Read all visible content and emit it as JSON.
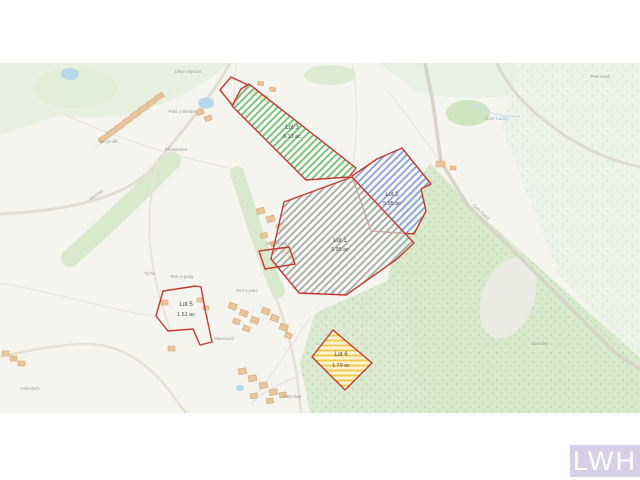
{
  "page": {
    "background": "#ffffff"
  },
  "logo": {
    "text": "LWH",
    "background": "#d6cfe7",
    "text_color": "#ffffff"
  },
  "lots": [
    {
      "name": "Lot 1",
      "area": "9.95 ac",
      "fill_style": "grey-hatch",
      "outline": "#c23b33"
    },
    {
      "name": "Lot 2",
      "area": "5.95 ac",
      "fill_style": "blue-hatch",
      "outline": "#c23b33"
    },
    {
      "name": "Lot 3",
      "area": "6.13 ac",
      "fill_style": "green-hatch",
      "outline": "#c23b33"
    },
    {
      "name": "Lot 5",
      "area": "1.51 ac",
      "fill_style": "none",
      "outline": "#c23b33"
    },
    {
      "name": "Lot 6",
      "area": "1.70 ac",
      "fill_style": "yellow-hatch",
      "outline": "#c23b33"
    }
  ],
  "map_labels": [
    "Llwyn Mynant",
    "Pant y Blodyn",
    "Rhydonnen",
    "Tan-yr-allt",
    "Heol-las",
    "Ty-hir",
    "Pen-y-graig",
    "Pen-y-parc",
    "Maescoch",
    "Wern Fawr",
    "Cefn Coed",
    "Pwll-coed",
    "Garn-fawr",
    "Cwm-byr",
    "Nant Cadno",
    "Felin-fach"
  ],
  "colors": {
    "lot_outline_red": "#c23b33",
    "hatch_green": "#6fbf73",
    "hatch_blue": "#8a9fd8",
    "hatch_grey": "#a3aaa3",
    "hatch_yellow": "#f2c94c",
    "map_base": "#f6f4ee",
    "woodland": "#d8e9cc",
    "scrub": "#edf3e7",
    "water": "#b5d9e8",
    "building": "#e9c49c"
  }
}
